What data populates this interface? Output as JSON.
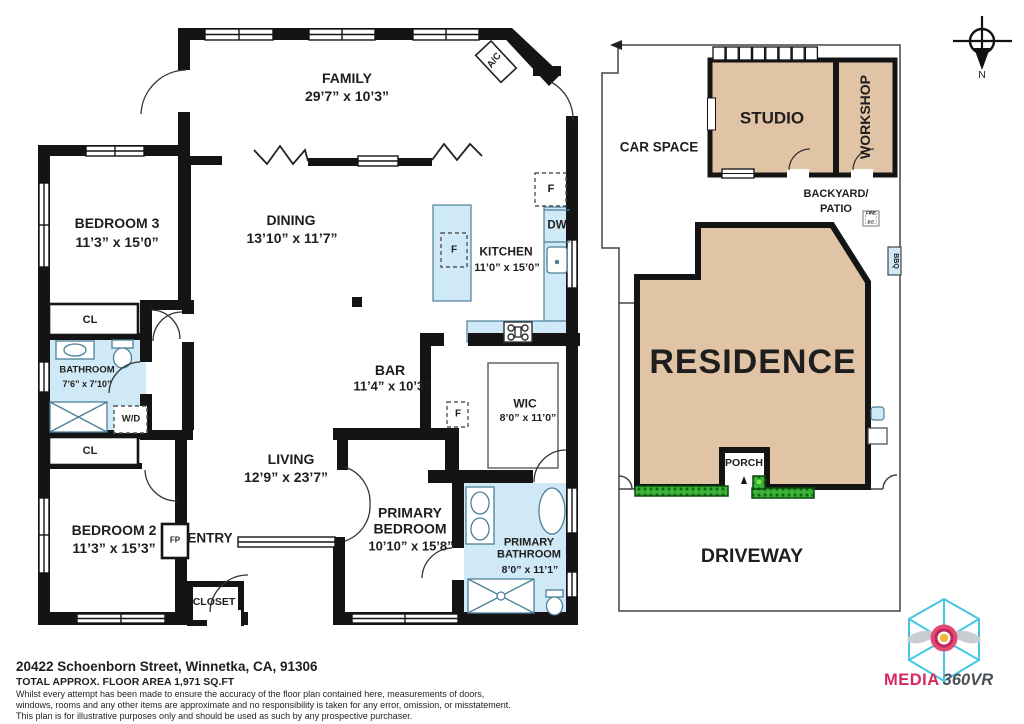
{
  "rooms": [
    {
      "name": "FAMILY",
      "dims": "29’7” x 10’3”"
    },
    {
      "name": "DINING",
      "dims": "13’10” x 11’7”"
    },
    {
      "name": "KITCHEN",
      "dims": "11’0” x 15’0”"
    },
    {
      "name": "BEDROOM 3",
      "dims": "11’3” x 15’0”"
    },
    {
      "name": "BATHROOM",
      "dims": "7’6” x 7’10”"
    },
    {
      "name": "BEDROOM 2",
      "dims": "11’3” x 15’3”"
    },
    {
      "name": "LIVING",
      "dims": "12’9” x 23’7”"
    },
    {
      "name": "BAR",
      "dims": "11’4” x 10’3”"
    },
    {
      "name": "WIC",
      "dims": "8’0” x 11’0”"
    },
    {
      "name": "PRIMARY BEDROOM",
      "dims": "10’10” x 15’8”"
    },
    {
      "name": "PRIMARY BATHROOM",
      "dims": "8’0” x 11’1”"
    }
  ],
  "labels": {
    "cl": "CL",
    "wd": "W/D",
    "fp": "FP",
    "entry": "ENTRY",
    "closet": "CLOSET",
    "ac": "A/C",
    "fridge": "F",
    "dw": "DW"
  },
  "site": {
    "car_space": "CAR SPACE",
    "studio": "STUDIO",
    "workshop": "WORKSHOP",
    "backyard_line1": "BACKYARD/",
    "backyard_line2": "PATIO",
    "fire_pit_line1": "FIRE",
    "fire_pit_line2": "PIT",
    "bbq": "BBQ",
    "residence": "RESIDENCE",
    "porch": "PORCH",
    "driveway": "DRIVEWAY"
  },
  "compass": {
    "north": "N"
  },
  "logo": {
    "media": "MEDIA",
    "rest": "360VR"
  },
  "address_block": {
    "address": "20422 Schoenborn Street, Winnetka, CA, 91306",
    "area": "TOTAL APPROX. FLOOR AREA 1,971 SQ.FT",
    "disclaimer1": "Whilst every attempt has been made to ensure the accuracy of the floor plan contained here, measurements of doors,",
    "disclaimer2": "windows, rooms and any other items are approximate and no responsibility is taken for any error, omission, or misstatement.",
    "disclaimer3": "This plan is for illustrative purposes only and should be used as such by any prospective purchaser."
  },
  "colors": {
    "wall": "#141414",
    "fixture_blue": "#cfe9f6",
    "fixture_border": "#4c7f99",
    "building_tan": "#e1c3a5",
    "hedge_green": "#3db239",
    "logo_cyan": "#45c6e3",
    "logo_pink": "#d42a5e"
  }
}
